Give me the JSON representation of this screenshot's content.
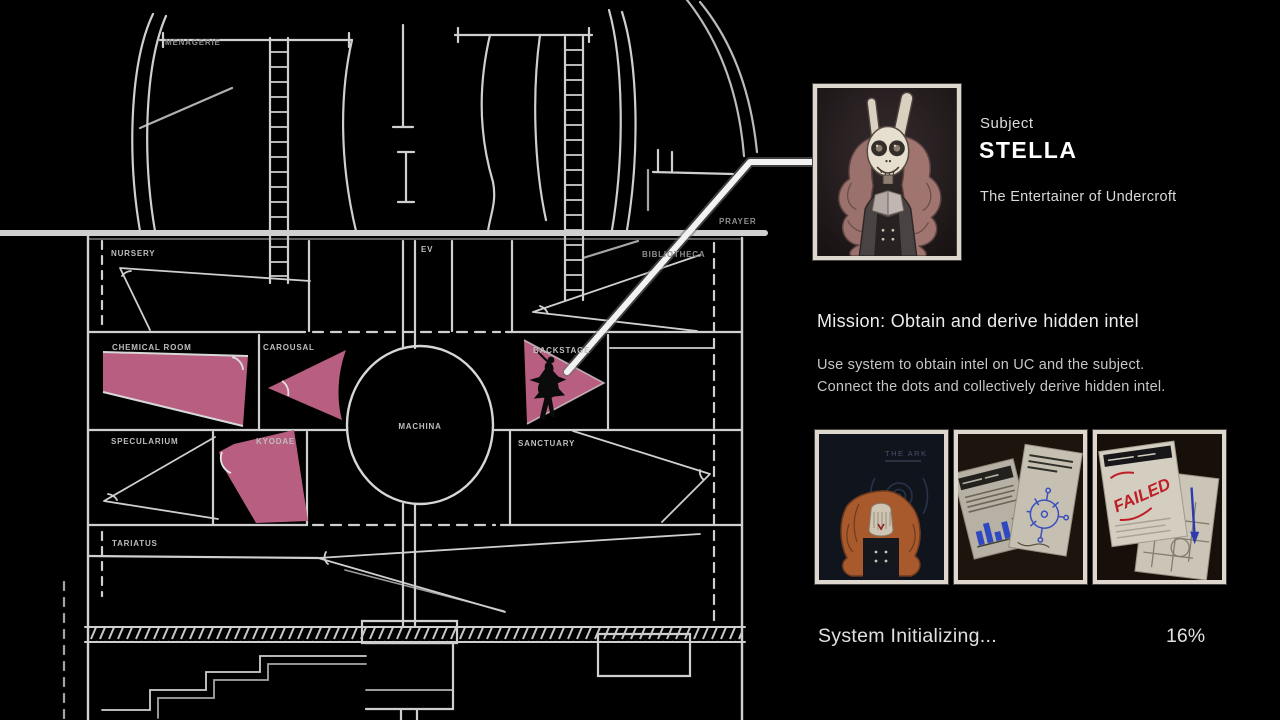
{
  "map": {
    "line_color": "#d2d2d2",
    "highlight_color": "#b85e80",
    "rooms": [
      {
        "id": "menagerie",
        "label": "MENAGERIE",
        "highlighted": false
      },
      {
        "id": "prayer",
        "label": "PRAYER",
        "highlighted": false
      },
      {
        "id": "nursery",
        "label": "NURSERY",
        "highlighted": false
      },
      {
        "id": "ev",
        "label": "EV",
        "highlighted": false
      },
      {
        "id": "bibliotheca",
        "label": "BIBLIOTHECA",
        "highlighted": false
      },
      {
        "id": "chemical-room",
        "label": "CHEMICAL ROOM",
        "highlighted": true
      },
      {
        "id": "carousal",
        "label": "CAROUSAL",
        "highlighted": true
      },
      {
        "id": "backstage",
        "label": "BACKSTAGE",
        "highlighted": true
      },
      {
        "id": "machina",
        "label": "MACHINA",
        "highlighted": false
      },
      {
        "id": "specularium",
        "label": "SPECULARIUM",
        "highlighted": false
      },
      {
        "id": "kyodae",
        "label": "KYODAE",
        "highlighted": true
      },
      {
        "id": "sanctuary",
        "label": "SANCTUARY",
        "highlighted": false
      },
      {
        "id": "tariatus",
        "label": "TARIATUS",
        "highlighted": false
      }
    ]
  },
  "subject_panel": {
    "subject_label": "Subject",
    "subject_name": "STELLA",
    "subject_title": "The Entertainer of Undercroft"
  },
  "mission": {
    "heading": "Mission: Obtain and derive hidden intel",
    "body_line1": "Use system to obtain intel on UC and the subject.",
    "body_line2": "Connect the dots and collectively derive hidden intel."
  },
  "intel_thumbnails": [
    {
      "name": "the-ark-cover",
      "caption": "THE ARK"
    },
    {
      "name": "energy-report-documents",
      "caption": ""
    },
    {
      "name": "failed-note",
      "stamp": "FAILED"
    }
  ],
  "status": {
    "text": "System Initializing...",
    "percent": "16%"
  }
}
